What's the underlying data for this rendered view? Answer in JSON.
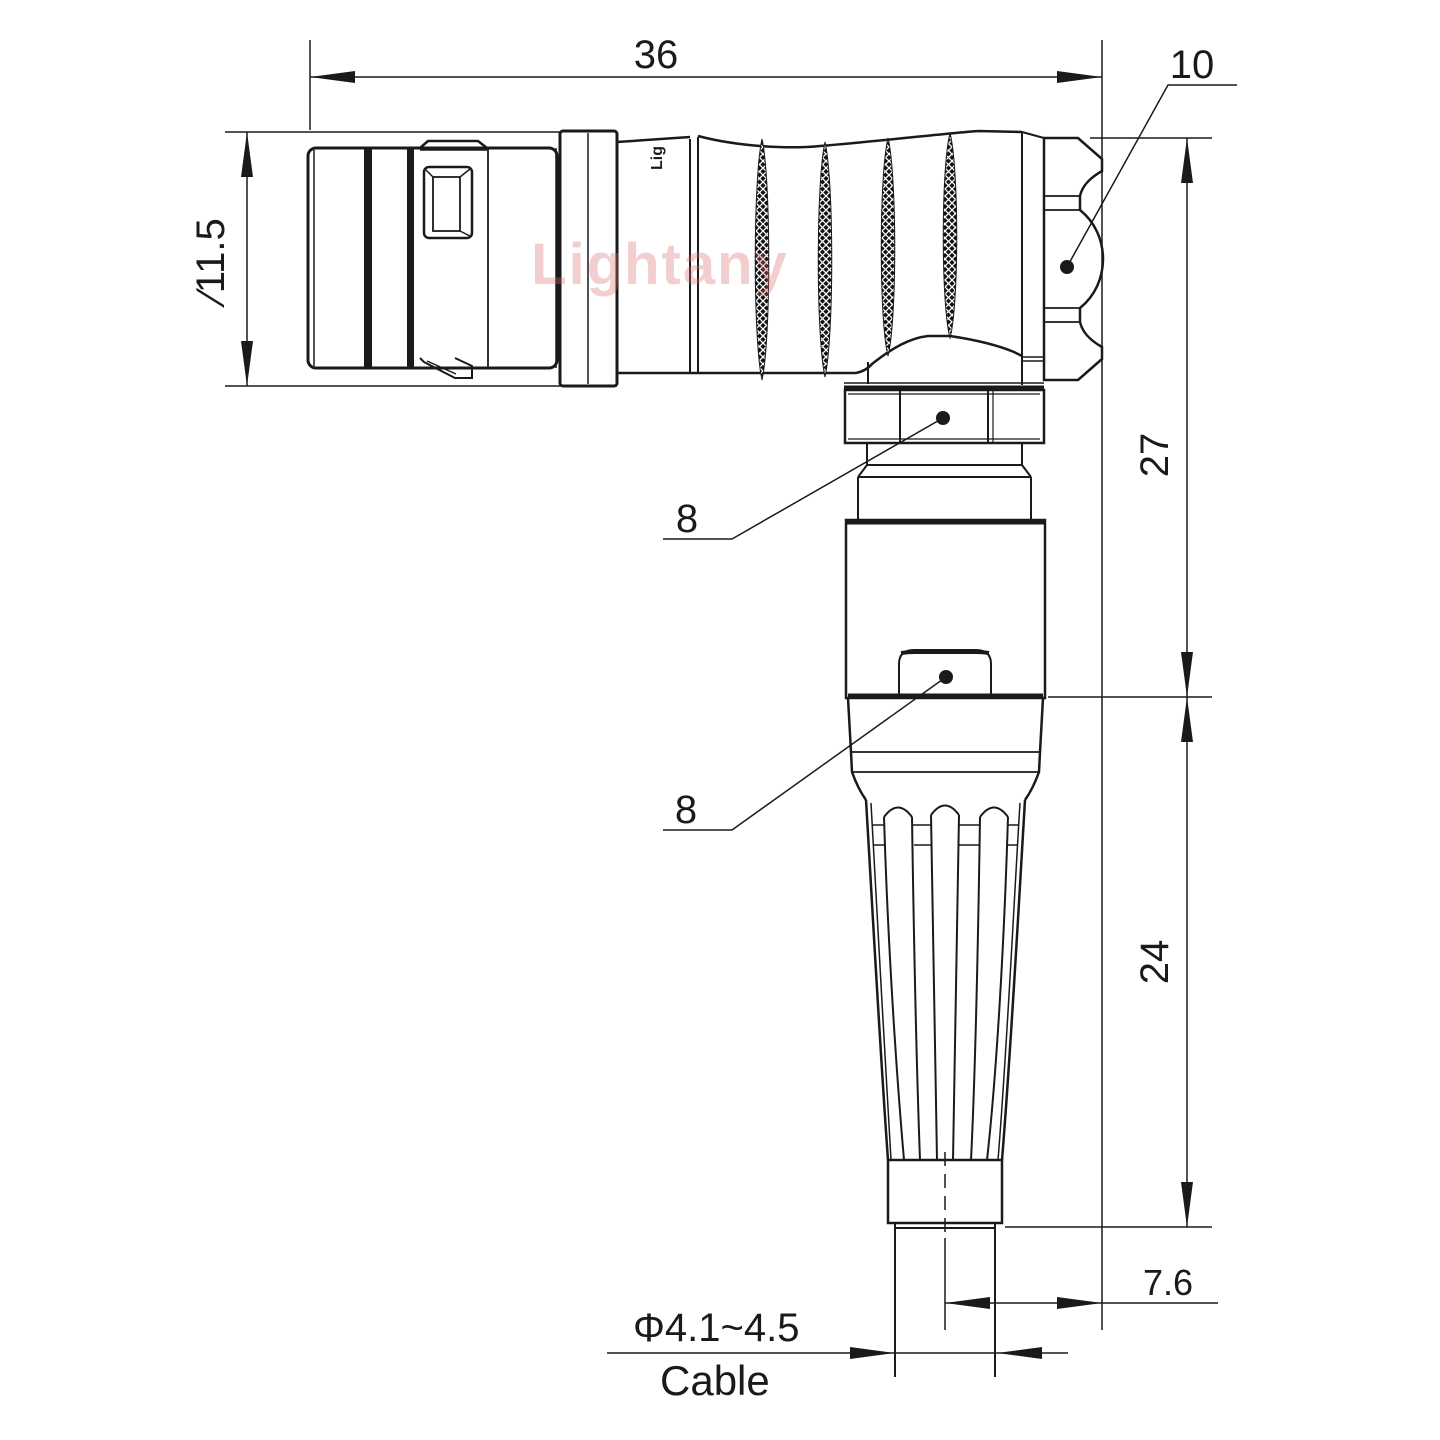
{
  "drawing": {
    "type": "engineering-drawing",
    "subject": "right-angle circular push-pull connector with cable strain relief, side view",
    "dimensions": {
      "overall_length": "36",
      "coupling_nut_callout": "10",
      "front_shell_diameter": "∕11.5",
      "upper_height": "27",
      "lower_height": "24",
      "cable_axis_offset": "7.6",
      "backnut_callout_top": "8",
      "backnut_callout_bottom": "8",
      "cable_diameter_range": "Φ4.1~4.5",
      "cable_label": "Cable"
    },
    "watermark": "Lightany",
    "brand_mark": "Lig",
    "colors": {
      "line": "#1a1a1a",
      "watermark": "#db6c6c",
      "background": "#ffffff"
    }
  }
}
